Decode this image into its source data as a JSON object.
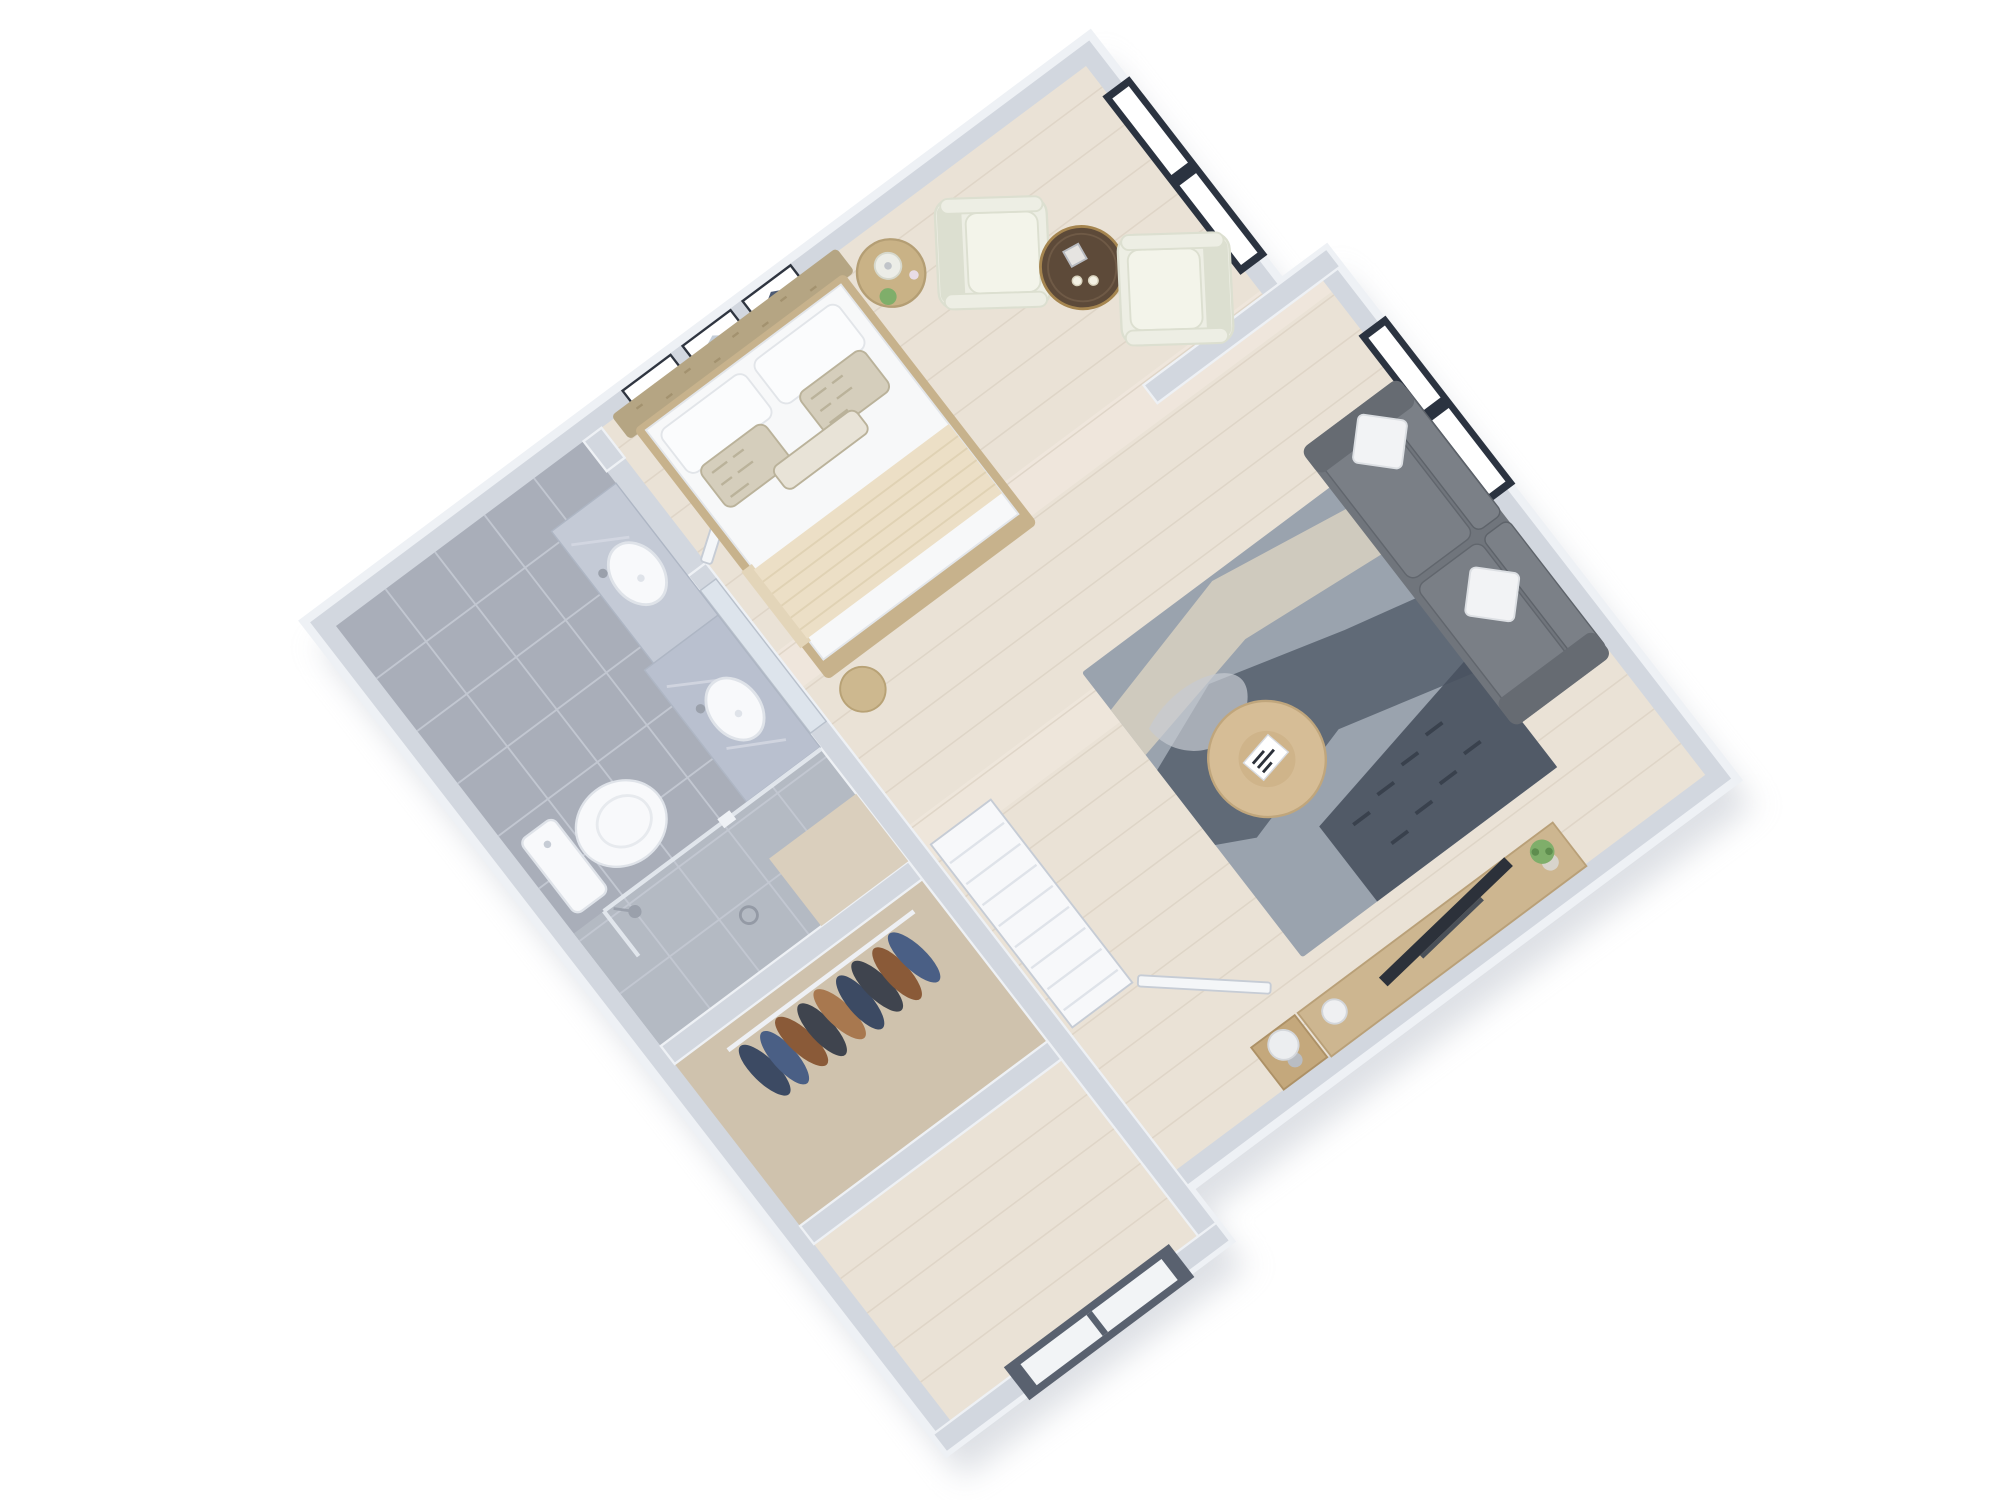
{
  "scene": {
    "type": "3d-floor-plan",
    "subject": "studio apartment dollhouse view",
    "view": "axonometric-top-down",
    "background": "#ffffff"
  },
  "palette": {
    "wall": "#d2d7df",
    "wallTop": "#eef1f5",
    "wallShade": "#c3c9d3",
    "shadow": "#c2c7d0",
    "floorWood": "#eae2d6",
    "floorWoodLine": "#dcd2c4",
    "floorWoodLight": "#f1eae0",
    "tile": "#a9aeb9",
    "tileLine": "#c2c7d1",
    "showerFloor": "#b4bac3",
    "showerMat": "#dacfbd",
    "closetFloor": "#cfc2ad",
    "doorWhite": "#f4f6f8",
    "doorStroke": "#c6ccd5",
    "windowFrame": "#2b3340",
    "glass": "#ffffff",
    "marble": "#c4cad6",
    "marble2": "#b9c0cf",
    "porcelain": "#f8f9fb",
    "porcelainShade": "#dfe3e9",
    "metal": "#9aa0ab",
    "headboard": "#b5a583",
    "bedFrame": "#c7b28c",
    "bedWhite": "#f7f8f9",
    "blanket": "#ecdfc6",
    "blanketDrape": "#e3d5b9",
    "pillowPattern": "#d5cebc",
    "pillowPatternLine": "#bab29a",
    "ivoryChair": "#edeee4",
    "ivoryChairShade": "#dcdfd0",
    "ivorySeat": "#f3f4ea",
    "sofa": "#70757c",
    "sofaCushion": "#7b8087",
    "sofaSeat": "#7a7f86",
    "sofaDark": "#5e636a",
    "pillowWhite": "#f2f3f5",
    "rugBase": "#9aa3ae",
    "rugCream": "#d5cec0",
    "rugDark": "#56606d",
    "rugDarker": "#49525f",
    "rugLight": "#c6cbd1",
    "woodTable": "#d6bd96",
    "woodTableEdge": "#c0a67c",
    "sideTableTop": "#5d4a39",
    "brass": "#a5854f",
    "candle": "#f4f1e4",
    "nightstand": "#c9b286",
    "nightstandEdge": "#b49e74",
    "console": "#cdb690",
    "cubeTable": "#c4a87c",
    "tv": "#2c313a",
    "plant": "#7fae6a",
    "plantDark": "#5e8d4e",
    "pot": "#d8d4cc",
    "entryFrame": "#59616f",
    "entryPanel": "#f2f4f6",
    "mirror": "#dde4ec",
    "artFrame": "#2f3540",
    "artBlue": "#8fa3bd",
    "artDark": "#4d5b74",
    "artLight": "#c3cdd8",
    "clothesNavy": "#3c4a63",
    "clothesBlue": "#4a5f85",
    "clothesBrown": "#8a5a38",
    "clothesDark": "#3f444e",
    "clothesTan": "#a8784f"
  },
  "labels": {
    "plan": "Studio apartment 3D floor plan",
    "bedroom": "Bedroom area",
    "bed": "Double bed with white bedding and beige throw",
    "headboard": "Tufted tan headboard",
    "wallArt": "Three framed abstract prints",
    "nightstand": "Round tan nightstand with lamp and succulent",
    "pouf": "Round pouf",
    "sittingArea": "Sitting nook",
    "armchair1": "Ivory armchair",
    "armchair2": "Ivory armchair",
    "sideTable": "Round side table with candles and lantern",
    "livingArea": "Living area",
    "sofa": "Gray fabric sofa with white pillows",
    "rug": "Blue-gray abstract area rug",
    "coffeeTable": "Round oak coffee table with books",
    "tvConsole": "Wood media console with TV and plant",
    "cubeTable": "Wood cube side table with lamp",
    "bathroom": "Bathroom",
    "vanity": "Double marble vanity",
    "sink1": "Oval sink",
    "sink2": "Oval sink",
    "mirror": "Vanity mirror",
    "toilet": "Toilet",
    "shower": "Walk-in glass shower",
    "closet": "Walk-in closet",
    "shelvingUnit": "White shelving unit",
    "clothesRod": "Hanging clothes on rod",
    "bathroomDoor": "Open bathroom door",
    "closetDoor": "Open closet door",
    "entry": "Entry vestibule",
    "entryDoor": "Dark-framed entry door",
    "window1": "Black-framed window (top wall)",
    "window2": "Black-framed window (right wall)",
    "partition": "Wall partition between windows"
  }
}
